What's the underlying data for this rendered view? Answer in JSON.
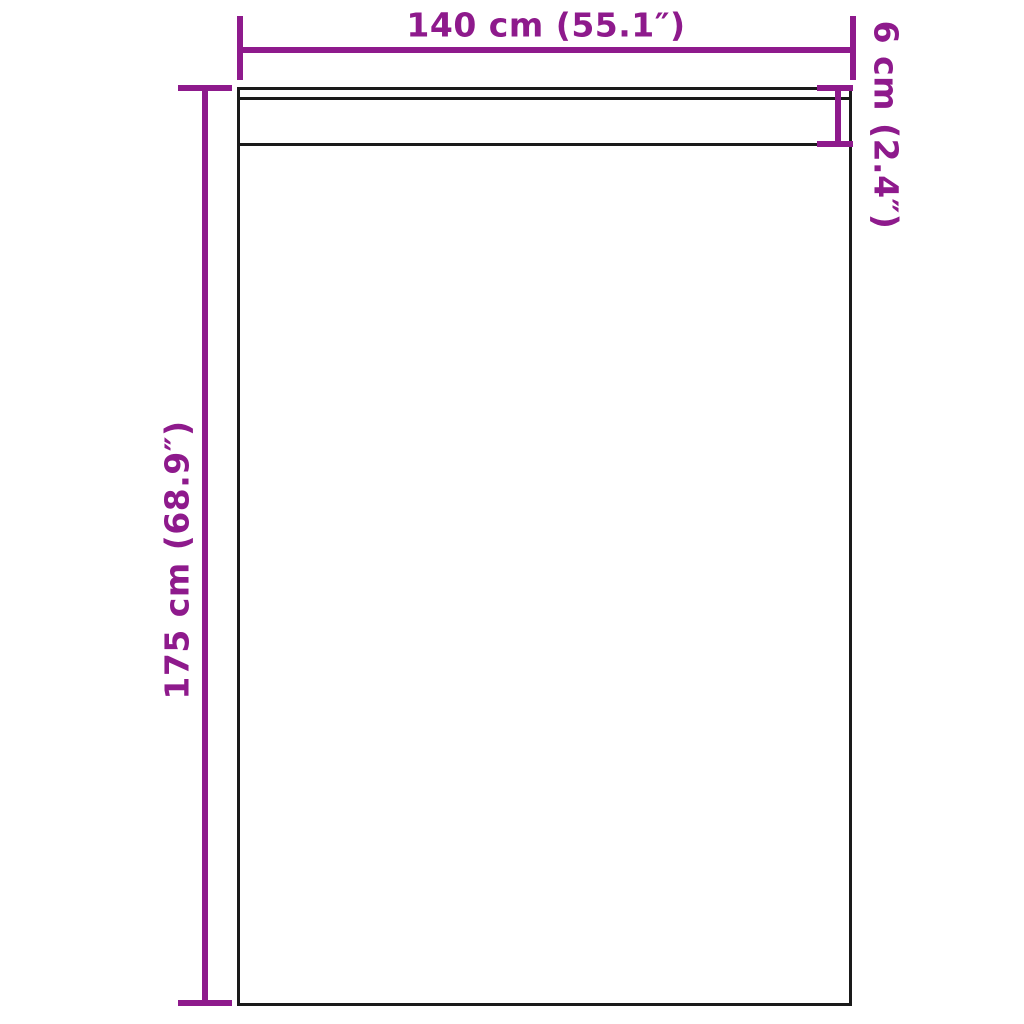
{
  "diagram": {
    "kind": "product-dimension-diagram",
    "colors": {
      "dimension_lines": "#8E1A8C",
      "outline": "#1A1A1A",
      "background": "#FFFFFF"
    },
    "dimensions": {
      "width_label": "140 cm (55.1″)",
      "height_label": "175 cm (68.9″)",
      "header_label": "6 cm (2.4″)"
    }
  }
}
